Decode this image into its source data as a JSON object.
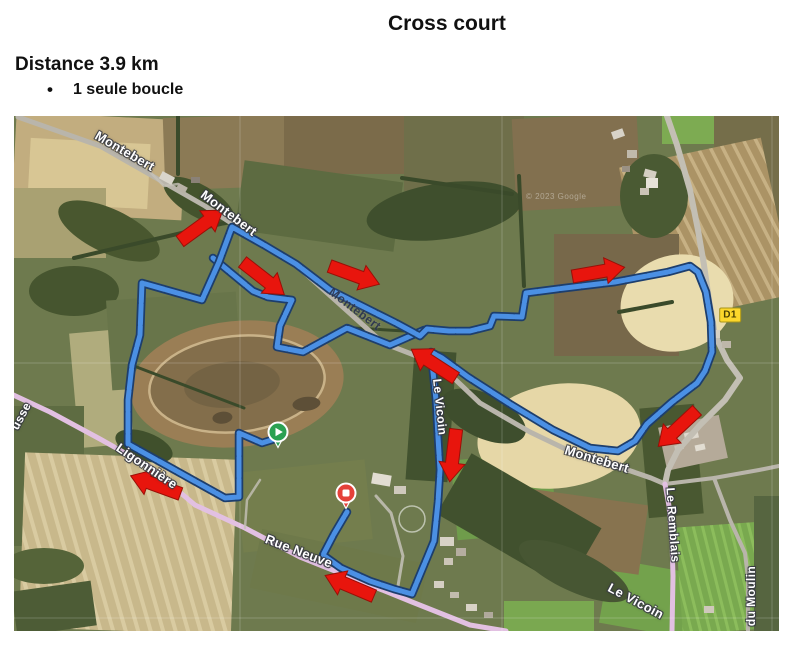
{
  "header": {
    "title": "Cross court",
    "distance": "Distance 3.9 km",
    "bullet_marker": "•",
    "bullet_text": "1 seule boucle"
  },
  "map": {
    "attribution": "© 2023 Google",
    "d1_badge": "D1",
    "colors": {
      "route_fill": "#4b90e4",
      "route_casing": "#1d3e6d",
      "arrow_fill": "#e8150d",
      "arrow_edge": "#9a0f07",
      "road_gray": "#b9b5ab",
      "road_pink": "#e2c0e2",
      "start_pin": "#2ba152",
      "finish_pin": "#e5413a"
    },
    "route": {
      "main": [
        [
          264,
          322
        ],
        [
          248,
          327
        ],
        [
          225,
          317
        ],
        [
          225,
          381
        ],
        [
          211,
          382
        ],
        [
          114,
          328
        ],
        [
          114,
          284
        ],
        [
          118,
          249
        ],
        [
          126,
          219
        ],
        [
          128,
          167
        ],
        [
          188,
          184
        ],
        [
          205,
          146
        ],
        [
          218,
          111
        ],
        [
          250,
          129
        ],
        [
          282,
          148
        ],
        [
          316,
          174
        ],
        [
          348,
          190
        ],
        [
          382,
          207
        ],
        [
          406,
          220
        ],
        [
          413,
          213
        ],
        [
          435,
          215
        ],
        [
          456,
          215
        ],
        [
          476,
          210
        ],
        [
          480,
          200
        ],
        [
          508,
          201
        ],
        [
          512,
          177
        ],
        [
          551,
          172
        ],
        [
          601,
          166
        ],
        [
          654,
          156
        ],
        [
          676,
          150
        ],
        [
          684,
          156
        ],
        [
          692,
          176
        ],
        [
          697,
          206
        ],
        [
          698,
          236
        ],
        [
          691,
          255
        ],
        [
          683,
          267
        ],
        [
          658,
          286
        ],
        [
          633,
          308
        ],
        [
          621,
          325
        ],
        [
          604,
          335
        ],
        [
          576,
          332
        ],
        [
          539,
          314
        ],
        [
          496,
          288
        ],
        [
          454,
          261
        ],
        [
          428,
          242
        ],
        [
          417,
          236
        ],
        [
          419,
          256
        ],
        [
          422,
          284
        ],
        [
          424,
          321
        ],
        [
          426,
          354
        ],
        [
          424,
          386
        ],
        [
          420,
          425
        ],
        [
          398,
          478
        ],
        [
          380,
          473
        ],
        [
          356,
          465
        ],
        [
          327,
          452
        ],
        [
          309,
          439
        ],
        [
          320,
          418
        ],
        [
          333,
          396
        ]
      ],
      "secondary": [
        [
          199,
          142
        ],
        [
          239,
          175
        ],
        [
          254,
          181
        ],
        [
          278,
          184
        ],
        [
          266,
          210
        ],
        [
          263,
          231
        ],
        [
          289,
          236
        ],
        [
          333,
          212
        ],
        [
          376,
          229
        ],
        [
          410,
          214
        ]
      ]
    },
    "arrows": [
      {
        "x": 187,
        "y": 110,
        "rot": -36
      },
      {
        "x": 249,
        "y": 162,
        "rot": 38
      },
      {
        "x": 340,
        "y": 159,
        "rot": 20
      },
      {
        "x": 584,
        "y": 156,
        "rot": -10
      },
      {
        "x": 420,
        "y": 248,
        "rot": 213
      },
      {
        "x": 439,
        "y": 339,
        "rot": 97
      },
      {
        "x": 664,
        "y": 312,
        "rot": 137
      },
      {
        "x": 142,
        "y": 369,
        "rot": 200
      },
      {
        "x": 336,
        "y": 470,
        "rot": 203
      }
    ],
    "markers": {
      "start": {
        "x": 264,
        "y": 316,
        "kind": "start"
      },
      "finish": {
        "x": 332,
        "y": 377,
        "kind": "finish"
      }
    },
    "labels": [
      {
        "id": "montebert-1",
        "text": "Montebert",
        "x": 111,
        "y": 35,
        "rot": 30,
        "size": 13,
        "variant": "light"
      },
      {
        "id": "montebert-2",
        "text": "Montebert",
        "x": 215,
        "y": 97,
        "rot": 37,
        "size": 13,
        "variant": "light"
      },
      {
        "id": "montebert-3",
        "text": "Montebert",
        "x": 341,
        "y": 193,
        "rot": 37,
        "size": 12,
        "variant": "dark"
      },
      {
        "id": "montebert-4",
        "text": "Montebert",
        "x": 583,
        "y": 343,
        "rot": 17,
        "size": 13,
        "variant": "light"
      },
      {
        "id": "le-vicoin-stream",
        "text": "Le Vicoin",
        "x": 426,
        "y": 291,
        "rot": 84,
        "size": 12,
        "variant": "light"
      },
      {
        "id": "le-vicoin-2",
        "text": "Le Vicoin",
        "x": 622,
        "y": 485,
        "rot": 28,
        "size": 13,
        "variant": "light"
      },
      {
        "id": "le-remblais",
        "text": "Le Remblais",
        "x": 659,
        "y": 409,
        "rot": 86,
        "size": 12,
        "variant": "light"
      },
      {
        "id": "du-moulin",
        "text": "du Moulin",
        "x": 737,
        "y": 480,
        "rot": -90,
        "size": 12,
        "variant": "light"
      },
      {
        "id": "ligonniere",
        "text": "Ligonnière",
        "x": 133,
        "y": 350,
        "rot": 34,
        "size": 13,
        "variant": "light"
      },
      {
        "id": "rue-neuve",
        "text": "Rue Neuve",
        "x": 285,
        "y": 435,
        "rot": 21,
        "size": 13,
        "variant": "light"
      },
      {
        "id": "usse",
        "text": "usse",
        "x": 7,
        "y": 300,
        "rot": -62,
        "size": 12,
        "variant": "light"
      },
      {
        "id": "d1-badge",
        "text": "D1",
        "x": 716,
        "y": 199,
        "rot": 0,
        "size": 10,
        "variant": "badge"
      }
    ]
  }
}
